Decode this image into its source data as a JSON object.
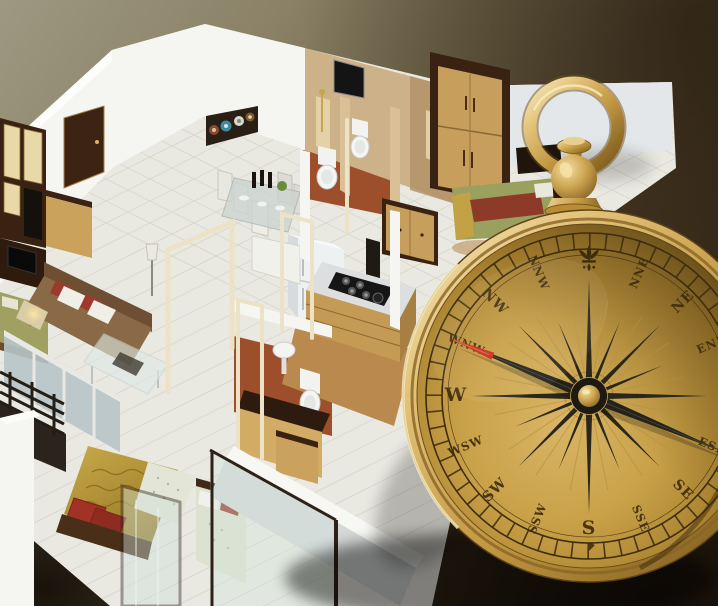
{
  "scene": {
    "description": "3D isometric rendering of an apartment floor plan with a large antique brass direction compass standing at the right side (vastu home-direction concept image)",
    "background": {
      "top_left": "#9e9882",
      "mid": "#6b5f44",
      "right_dark": "#352718",
      "vignette": "#0e0903"
    }
  },
  "compass": {
    "type": "antique-brass-pocket-compass",
    "directions": [
      "N",
      "NNE",
      "NE",
      "ENE",
      "E",
      "ESE",
      "SE",
      "SSE",
      "S",
      "SSW",
      "SW",
      "WSW",
      "W",
      "WNW",
      "NW",
      "NNW"
    ],
    "north_marker": "fleur-de-lis",
    "needle": {
      "points_to": "WNW",
      "tip_color": "#c5301d",
      "body_color": "#24221a"
    },
    "features": [
      "ring-handle",
      "ball-knob",
      "tick-ring",
      "16-point-star-burst",
      "brass-center-hub"
    ],
    "colors": {
      "rim_light": "#f7e9bc",
      "rim_mid": "#c49a44",
      "rim_dark": "#6e4f1a",
      "dial_light": "#d9b566",
      "dial_dark": "#7d5c1d",
      "markings": "#3e2c0c"
    }
  },
  "floorplan": {
    "style": "isometric-3d-white-walls",
    "rooms": [
      {
        "name": "entrance-hall",
        "items": [
          "wooden-door",
          "flower-wall-art"
        ]
      },
      {
        "name": "living-room",
        "items": [
          "brown-sofa",
          "red-white-cushions",
          "glass-coffee-table",
          "tv-unit",
          "floor-lamp",
          "balcony-glass-door"
        ]
      },
      {
        "name": "dining-area",
        "items": [
          "glass-dining-table",
          "white-chairs",
          "bottles",
          "plant"
        ]
      },
      {
        "name": "kitchen",
        "items": [
          "gas-hob",
          "counter-drawers",
          "refrigerator",
          "overhead-wood-cabinets"
        ]
      },
      {
        "name": "bathroom-1",
        "items": [
          "toilet",
          "shower-panel",
          "window"
        ]
      },
      {
        "name": "bathroom-2",
        "items": [
          "toilet",
          "washbasin",
          "vanity-cabinet"
        ]
      },
      {
        "name": "master-bedroom",
        "items": [
          "olive-bed",
          "wardrobe",
          "side-cabinet"
        ]
      },
      {
        "name": "bedroom-2",
        "items": [
          "gold-patterned-bed",
          "red-pillows",
          "glass-partition"
        ]
      },
      {
        "name": "bedroom-3",
        "items": [
          "pale-bed",
          "wood-cabinet",
          "glass-partition"
        ]
      },
      {
        "name": "balcony",
        "items": [
          "dark-wood-railing"
        ]
      }
    ],
    "palette": {
      "walls": "#f5f5f1",
      "floor_tiles": "#e9e8e1",
      "bathroom_floor": "#9c4f2a",
      "wood_light": "#c79e5c",
      "wood_dark": "#3a2212",
      "sofa": "#8a6a46",
      "accent_red": "#9c3a2c",
      "bed_olive": "#9fa061",
      "bed_gold": "#c2a244"
    }
  }
}
